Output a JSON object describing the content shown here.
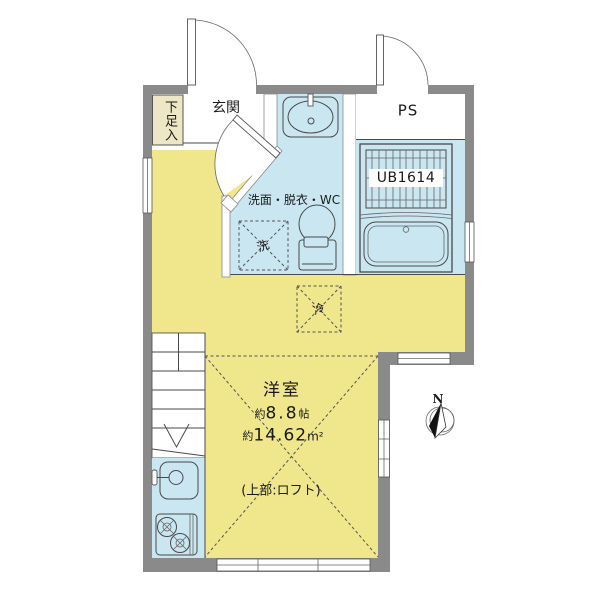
{
  "colors": {
    "wall": "#8A8A8A",
    "floor": "#F0E68C",
    "water": "#C9E6F1",
    "cabinet": "#EDE7C5",
    "line": "#4A4A4A"
  },
  "rooms": {
    "entrance": {
      "label": "玄関"
    },
    "shoe_cabinet": {
      "label": "下足入"
    },
    "pipe_space": {
      "label": "PS"
    },
    "unit_bath": {
      "label": "UB1614"
    },
    "washroom": {
      "label": "洗面・脱衣・WC"
    },
    "main_room": {
      "label": "洋室",
      "approx1": "約",
      "size_jo": "8.8",
      "unit_jo": "帖",
      "approx2": "約",
      "size_sqm": "14.62",
      "unit_sqm": "m²",
      "loft_note": "(上部:ロフト)"
    }
  },
  "fixtures": {
    "washing_machine": {
      "label": "洗"
    },
    "refrigerator": {
      "label": "冷"
    }
  },
  "compass": {
    "north": "N"
  }
}
